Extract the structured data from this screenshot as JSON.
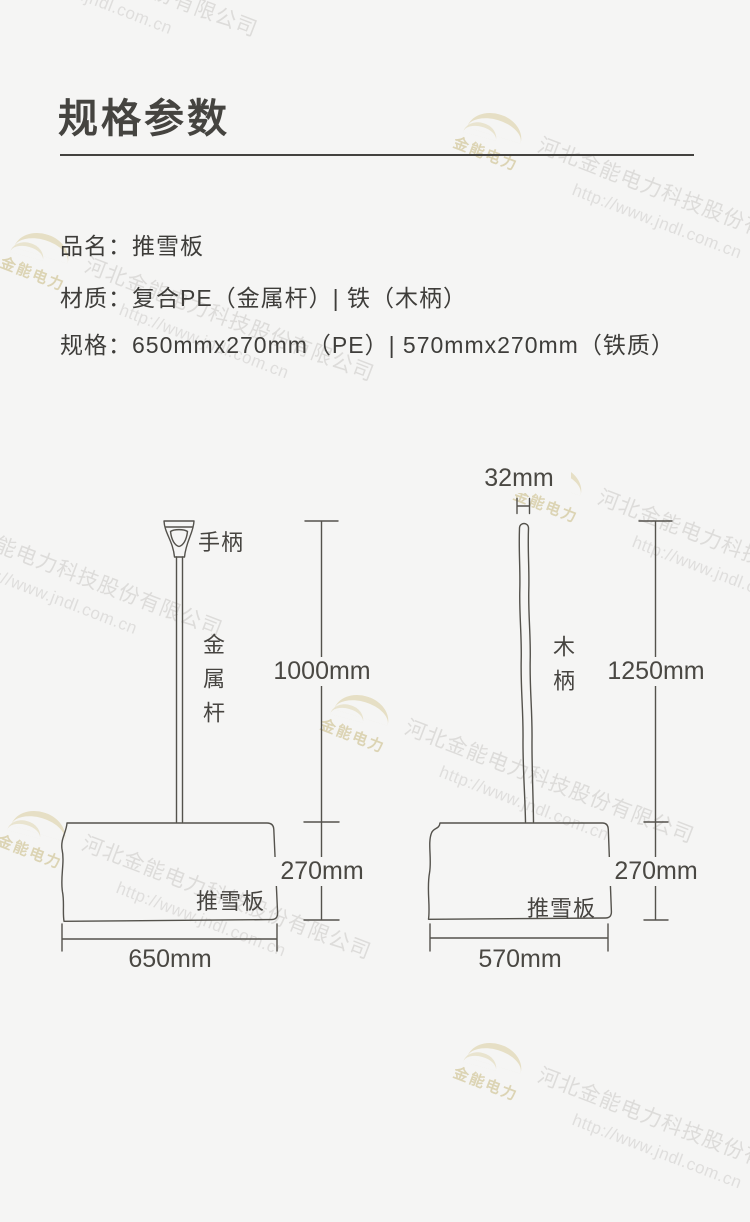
{
  "header": {
    "title": "规格参数"
  },
  "specs": [
    {
      "label": "品名：",
      "value": "推雪板"
    },
    {
      "label": "材质：",
      "value": "复合PE（金属杆）| 铁（木柄）"
    },
    {
      "label": "规格：",
      "value": "650mmx270mm（PE）| 570mmx270mm（铁质）"
    }
  ],
  "diagram_left": {
    "handle_label": "手柄",
    "pole_label": "金属杆",
    "board_label": "推雪板",
    "dim_height": "1000mm",
    "dim_board": "270mm",
    "dim_width": "650mm"
  },
  "diagram_right": {
    "dim_top": "32mm",
    "pole_label": "木柄",
    "board_label": "推雪板",
    "dim_height": "1250mm",
    "dim_board": "270mm",
    "dim_width": "570mm"
  },
  "watermark": {
    "company": "河北金能电力科技股份有限公司",
    "url": "http://www.jndl.com.cn",
    "logo_text": "金能电力"
  },
  "colors": {
    "background": "#f5f5f4",
    "text": "#3e3d3a",
    "line_art": "#54524c",
    "watermark_logo": "#d2c284"
  }
}
